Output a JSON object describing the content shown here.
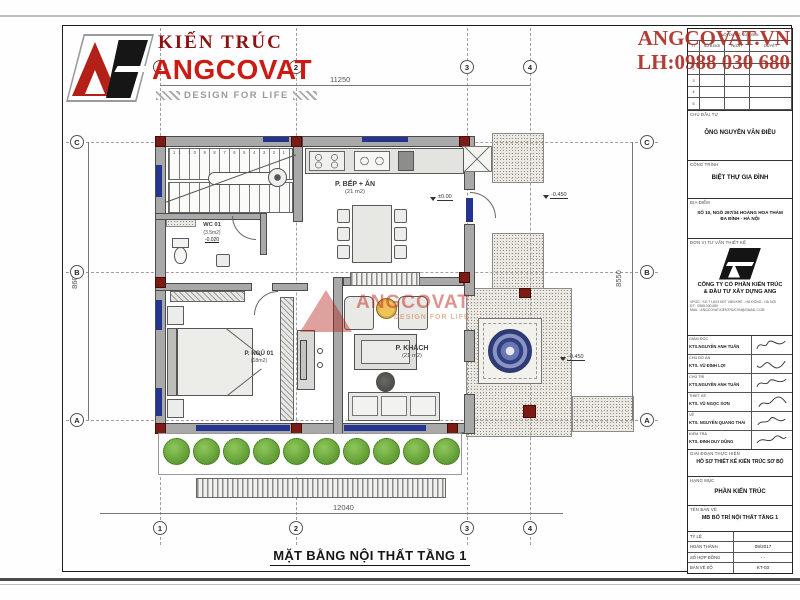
{
  "branding": {
    "logo_top": "KIẾN TRÚC",
    "logo_main": "ANGCOVAT",
    "tagline": "DESIGN FOR LIFE",
    "brand_red": "#c21d12",
    "dark_red": "#8c1212"
  },
  "contact": {
    "site": "ANGCOVAT.VN",
    "phone": "LH:0988 030 680"
  },
  "plan": {
    "title": "MẶT BẰNG NỘI THẤT TẦNG 1",
    "grid_cols": [
      "1",
      "2",
      "3",
      "4"
    ],
    "grid_rows": [
      "C",
      "B",
      "A"
    ],
    "dim_top": "11250",
    "dim_bottom": "12040",
    "dim_left": "8600",
    "dim_right": "8550",
    "rooms": {
      "kitchen_name": "P. BẾP + ĂN",
      "kitchen_area": "(21 m2)",
      "living_name": "P. KHÁCH",
      "living_area": "(21 m2)",
      "bedroom_name": "P. NGỦ 01",
      "bedroom_area": "(18m2)",
      "wc_name": "WC 01",
      "wc_area": "(3.5m2)",
      "wc_level": "-0.020"
    },
    "levels": {
      "main": "±0.00",
      "terrace": "-0.450",
      "porch": "-0.450"
    },
    "stairs_numbers": "11 10 9 8 7 6 5 4 3 2 1",
    "watermark_line1": "ANGCOVAT",
    "watermark_line2": "DESIGN FOR LIFE",
    "colors": {
      "window_blue": "#24358f",
      "column_red": "#7a1b15",
      "medallion_blue": "#33407d",
      "shrub_green": "#4c8a24"
    }
  },
  "titleblock": {
    "rev_header": "NỘI DUNG SỬA ĐỔI",
    "rev_cols": [
      "TT",
      "SỬA ĐỔI",
      "NGÀY",
      "DUYỆT"
    ],
    "rev_rows": [
      "1",
      "2",
      "3",
      "4",
      "5"
    ],
    "investor_label": "CHỦ ĐẦU TƯ",
    "investor": "ÔNG NGUYỄN VĂN ĐIỀU",
    "project_label": "CÔNG TRÌNH",
    "project": "BIỆT THỰ GIA ĐÌNH",
    "location_label": "ĐỊA ĐIỂM",
    "location_line1": "SỐ 10, NGÕ 267/34 HOÀNG HOA THÁM",
    "location_line2": "BA ĐÌNH - HÀ NỘI",
    "consultant_label": "ĐƠN VỊ TƯ VẤN THIẾT KẾ",
    "company_line1": "CÔNG TY CỔ PHẦN KIẾN TRÚC",
    "company_line2": "& ĐẦU TƯ XÂY DỰNG ANG",
    "company_info1": "VPGD : SỐ 7 LK03 KĐT VĂN KHÊ - HÀ ĐÔNG - HÀ NỘI",
    "company_info2": "ĐT : 0988.030.680",
    "company_info3": "MAIL : ANGCOVAT.KIENTRUCVN@GMAIL.COM",
    "signers": [
      {
        "role": "GIÁM ĐỐC",
        "name": "KTS.NGUYỄN ANH TUẤN"
      },
      {
        "role": "CHỦ ĐỒ ÁN",
        "name": "KTS. VŨ ĐÌNH LỢI"
      },
      {
        "role": "CHỦ TRÌ",
        "name": "KTS.NGUYỄN ANH TUẤN"
      },
      {
        "role": "THIẾT KẾ",
        "name": "KTS. VŨ NGỌC SƠN"
      },
      {
        "role": "VẼ",
        "name": "KTS. NGUYỄN QUANG THÁI"
      },
      {
        "role": "KIỂM TRA",
        "name": "KTS. ĐINH DUY DŨNG"
      }
    ],
    "stage_label": "GIAI ĐOẠN THỰC HIỆN",
    "stage": "HỒ SƠ THIẾT KẾ KIẾN TRÚC SƠ BỘ",
    "category_label": "HẠNG MỤC",
    "category": "PHẦN KIẾN TRÚC",
    "drawing_label": "TÊN BẢN VẼ",
    "drawing": "MB BỐ TRÍ NỘI THẤT TẦNG 1",
    "meta": [
      {
        "label": "TỶ LỆ",
        "value": ""
      },
      {
        "label": "HOÀN THÀNH",
        "value": "09/2017"
      },
      {
        "label": "SỐ HỢP ĐỒNG",
        "value": "- -"
      },
      {
        "label": "BẢN VẼ SỐ",
        "value": "KT-03"
      }
    ]
  }
}
